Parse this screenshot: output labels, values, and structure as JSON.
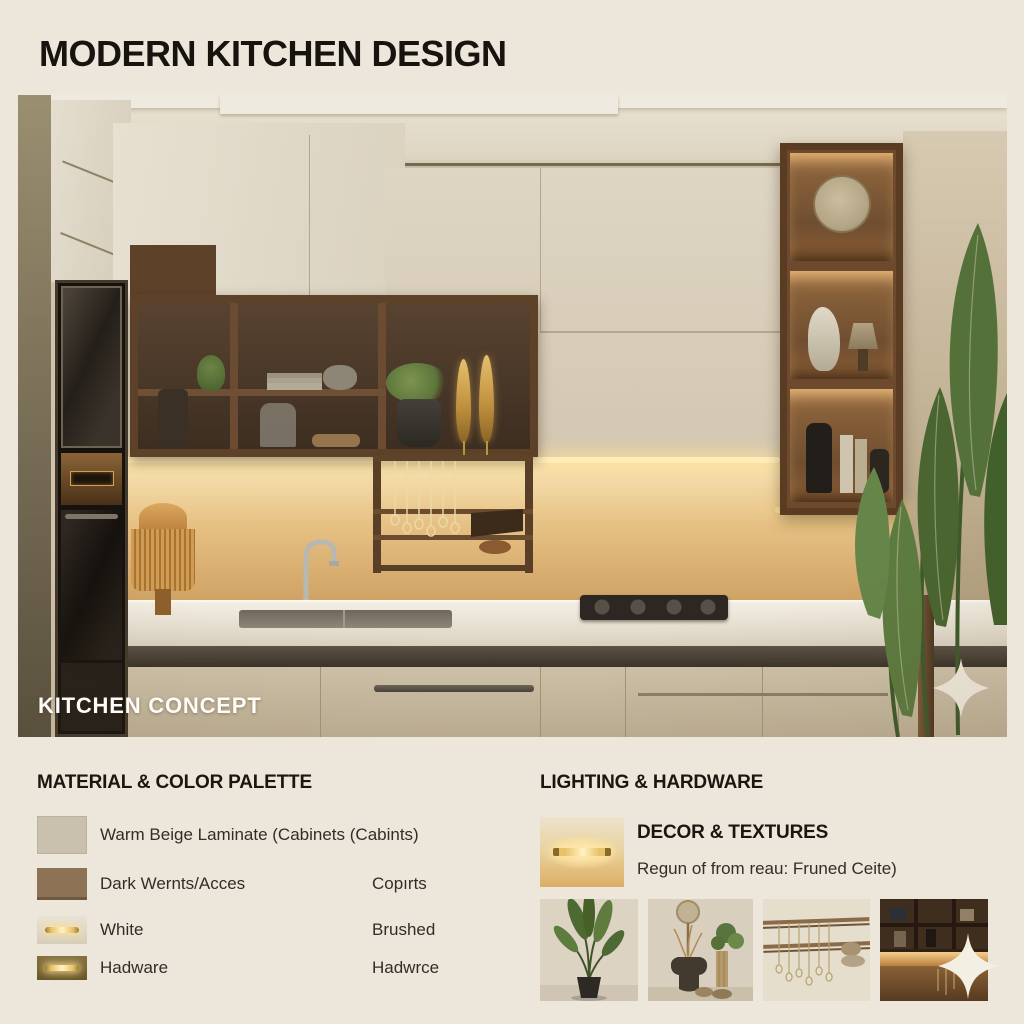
{
  "title": "MODERN KITCHEN DESIGN",
  "hero": {
    "caption": "KITCHEN CONCEPT"
  },
  "sections": {
    "material": {
      "heading": "MATERIAL & COLOR PALETTE",
      "rows": [
        {
          "label": "Warm Beige Laminate (Cabinets (Cabints)",
          "note": ""
        },
        {
          "label": "Dark Wernts/Acces",
          "note": "Copırts"
        },
        {
          "label": "White",
          "note": "Brushed"
        },
        {
          "label": "Hadware",
          "note": "Hadwrce"
        }
      ]
    },
    "lighting": {
      "heading": "LIGHTING & HARDWARE",
      "subheading": "DECOR & TEXTURES",
      "caption": "Regun of from reau: Fruned Ceite)"
    }
  },
  "decor_thumbnails": [
    "potted-palm-plant",
    "vases-and-dried-stems",
    "hanging-necklaces-rail",
    "lit-shelf-cabinet"
  ],
  "icons": {
    "sparkle": "four-point-star"
  },
  "colors": {
    "background": "#ece7da",
    "title_text": "#17130e",
    "swatch_warm_beige": "#c9c0ae",
    "swatch_dark_walnut": "#8d7256",
    "swatch_white": "#ded8ca",
    "swatch_brass_dark": "#84703f",
    "brass_glow": "#ffe9ad",
    "under_cabinet_glow": "#f8e4b4",
    "wood": "#6d4a2e",
    "plant_green": "#55703a",
    "counter_white": "#f3eee4"
  }
}
